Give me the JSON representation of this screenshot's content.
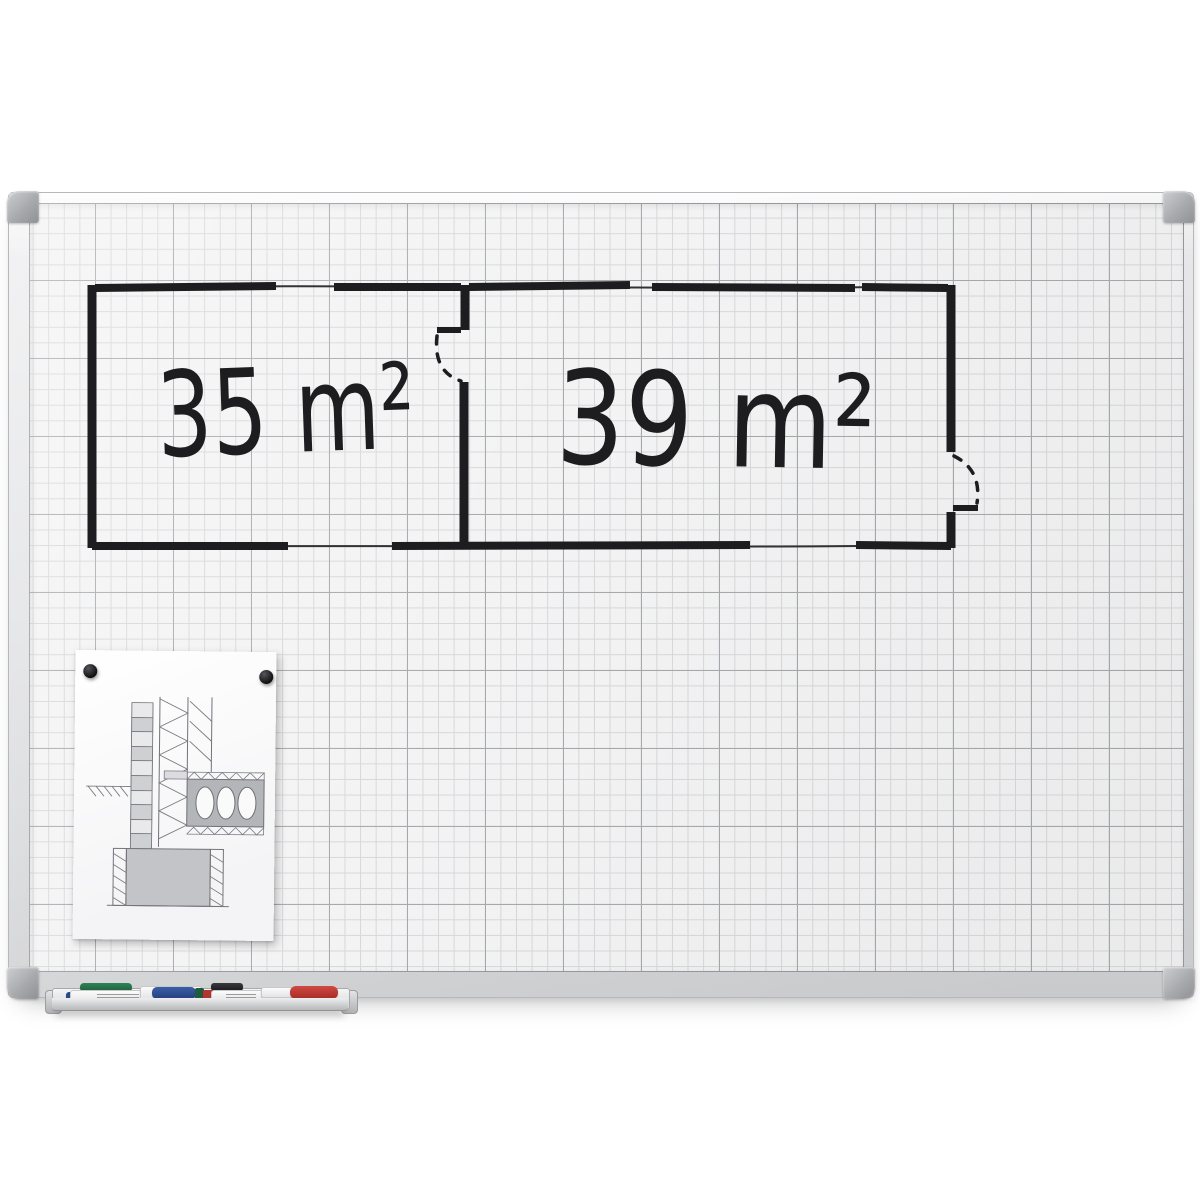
{
  "scene": {
    "background_color": "#ffffff"
  },
  "whiteboard": {
    "frame_color": "#e0e1e3",
    "corner_cap_color": "#a7a9ac",
    "surface_color": "#f3f3f4",
    "grid_minor_color": "#d5d7d8",
    "grid_major_color": "#a6a9ac"
  },
  "floor_plan": {
    "ink_color": "#1d1d20",
    "rooms": [
      {
        "label": "35 m²"
      },
      {
        "label": "39 m²"
      }
    ]
  },
  "pinned_sheet": {
    "paper_color": "#fcfcfd",
    "magnet_color": "#101012",
    "line_color": "#71727a",
    "concrete_fill": "#b4b5b8"
  },
  "pen_tray": {
    "rail_color": "#d2d3d5",
    "markers": [
      {
        "name": "green marker",
        "cap_color": "#1f6b46"
      },
      {
        "name": "blue marker",
        "cap_color": "#2b4a8c"
      },
      {
        "name": "black marker",
        "cap_color": "#232326"
      },
      {
        "name": "red marker",
        "cap_color": "#b5342f"
      }
    ]
  }
}
